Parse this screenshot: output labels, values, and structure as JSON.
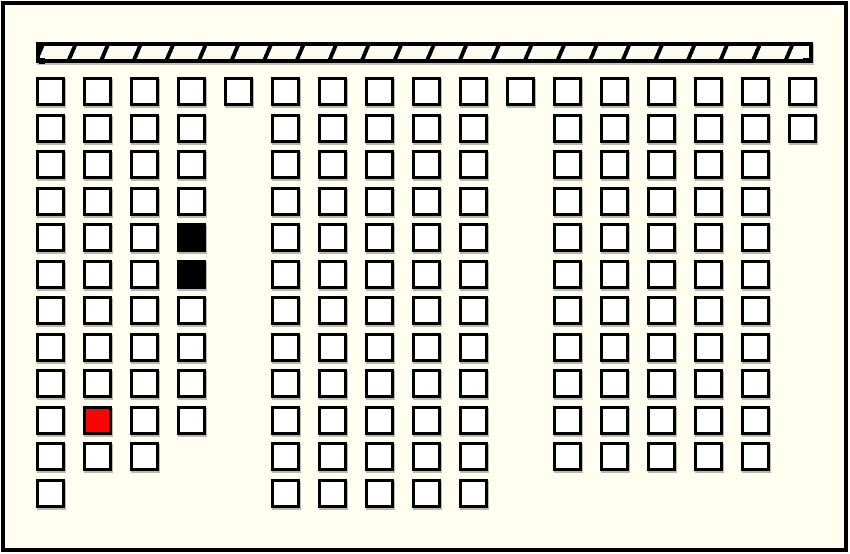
{
  "app": {
    "view": "cinema-seat-selection-map"
  },
  "colors": {
    "background": "#fffef0",
    "line": "#000000",
    "bar_fill": "#fbfbf2",
    "seat_available": "#ffffff",
    "seat_occupied": "#000000",
    "seat_selected": "#fa0505"
  },
  "screen_bar": {
    "x": 36,
    "y": 42,
    "width": 777,
    "height": 21,
    "hatch_direction": "forward-slash",
    "hatch_period_px": 30,
    "hatch_line_px": 4
  },
  "seat_map": {
    "geometry": {
      "origin_x": 36,
      "origin_y": 77,
      "pitch_x": 47,
      "pitch_y": 36.5,
      "seat_size": 29
    },
    "legend": {
      "available": "white",
      "occupied": "black",
      "selected": "red"
    },
    "rows": [
      {
        "cols": [
          0,
          1,
          2,
          3,
          4,
          5,
          6,
          7,
          8,
          9,
          10,
          11,
          12,
          13,
          14,
          15,
          16
        ]
      },
      {
        "cols": [
          0,
          1,
          2,
          3,
          5,
          6,
          7,
          8,
          9,
          11,
          12,
          13,
          14,
          15,
          16
        ]
      },
      {
        "cols": [
          0,
          1,
          2,
          3,
          5,
          6,
          7,
          8,
          9,
          11,
          12,
          13,
          14,
          15
        ]
      },
      {
        "cols": [
          0,
          1,
          2,
          3,
          5,
          6,
          7,
          8,
          9,
          11,
          12,
          13,
          14,
          15
        ]
      },
      {
        "cols": [
          0,
          1,
          2,
          3,
          5,
          6,
          7,
          8,
          9,
          11,
          12,
          13,
          14,
          15
        ]
      },
      {
        "cols": [
          0,
          1,
          2,
          3,
          5,
          6,
          7,
          8,
          9,
          11,
          12,
          13,
          14,
          15
        ]
      },
      {
        "cols": [
          0,
          1,
          2,
          3,
          5,
          6,
          7,
          8,
          9,
          11,
          12,
          13,
          14,
          15
        ]
      },
      {
        "cols": [
          0,
          1,
          2,
          3,
          5,
          6,
          7,
          8,
          9,
          11,
          12,
          13,
          14,
          15
        ]
      },
      {
        "cols": [
          0,
          1,
          2,
          3,
          5,
          6,
          7,
          8,
          9,
          11,
          12,
          13,
          14,
          15
        ]
      },
      {
        "cols": [
          0,
          1,
          2,
          3,
          5,
          6,
          7,
          8,
          9,
          11,
          12,
          13,
          14,
          15
        ]
      },
      {
        "cols": [
          0,
          1,
          2,
          5,
          6,
          7,
          8,
          9,
          11,
          12,
          13,
          14,
          15
        ]
      },
      {
        "cols": [
          0,
          5,
          6,
          7,
          8,
          9
        ]
      }
    ],
    "special_seats": [
      {
        "row": 4,
        "col": 3,
        "state": "occupied"
      },
      {
        "row": 5,
        "col": 3,
        "state": "occupied"
      },
      {
        "row": 9,
        "col": 1,
        "state": "selected"
      }
    ]
  }
}
